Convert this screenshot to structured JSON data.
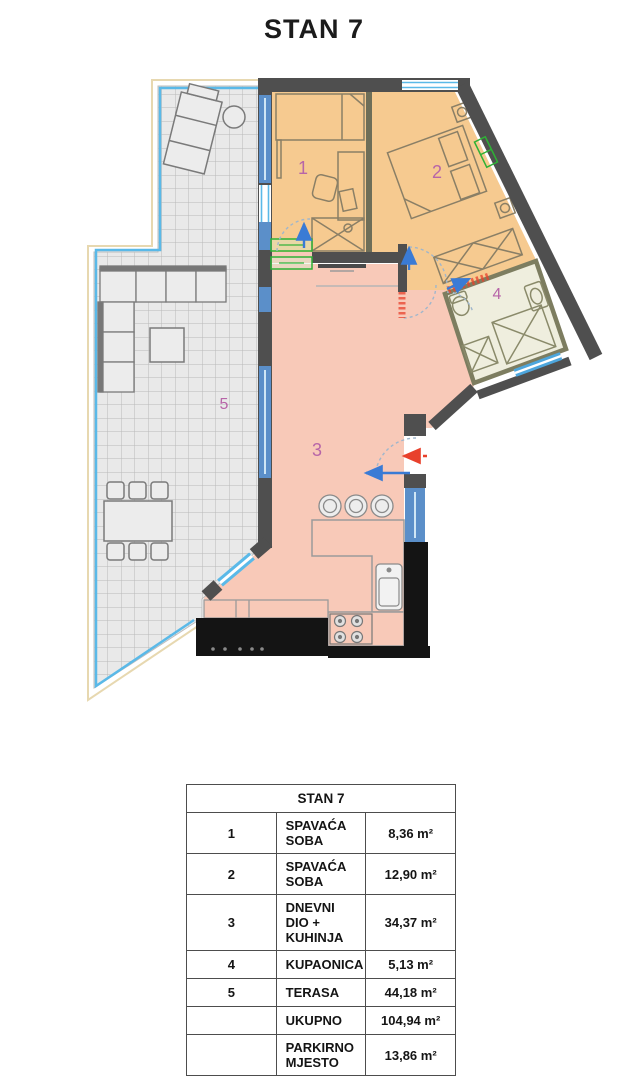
{
  "title": "STAN 7",
  "plan": {
    "rooms": [
      {
        "number": "1"
      },
      {
        "number": "2"
      },
      {
        "number": "3"
      },
      {
        "number": "4"
      },
      {
        "number": "5"
      }
    ],
    "colors": {
      "bedroom_fill": "#f6ca90",
      "living_fill": "#f8c9b8",
      "bathroom_fill": "#efeede",
      "terrace_fill": "#e9e9e9",
      "wall_gray": "#4f4f4f",
      "wall_black": "#141414",
      "window_blue": "#5b8fc9",
      "railing_blue": "#5ab9e8",
      "door_arrow_blue": "#3a7bd5",
      "entry_arrow_red": "#e8412c",
      "dimension_green": "#2eb135",
      "room_number": "#b765a8"
    }
  },
  "table": {
    "header": "STAN 7",
    "rows": [
      {
        "num": "1",
        "name": "SPAVAĆA SOBA",
        "area": "8,36 m²"
      },
      {
        "num": "2",
        "name": "SPAVAĆA SOBA",
        "area": "12,90 m²"
      },
      {
        "num": "3",
        "name": "DNEVNI DIO + KUHINJA",
        "area": "34,37 m²"
      },
      {
        "num": "4",
        "name": "KUPAONICA",
        "area": "5,13 m²"
      },
      {
        "num": "5",
        "name": "TERASA",
        "area": "44,18 m²"
      },
      {
        "num": "",
        "name": "UKUPNO",
        "area": "104,94 m²"
      },
      {
        "num": "",
        "name": "PARKIRNO MJESTO",
        "area": "13,86 m²"
      }
    ]
  }
}
